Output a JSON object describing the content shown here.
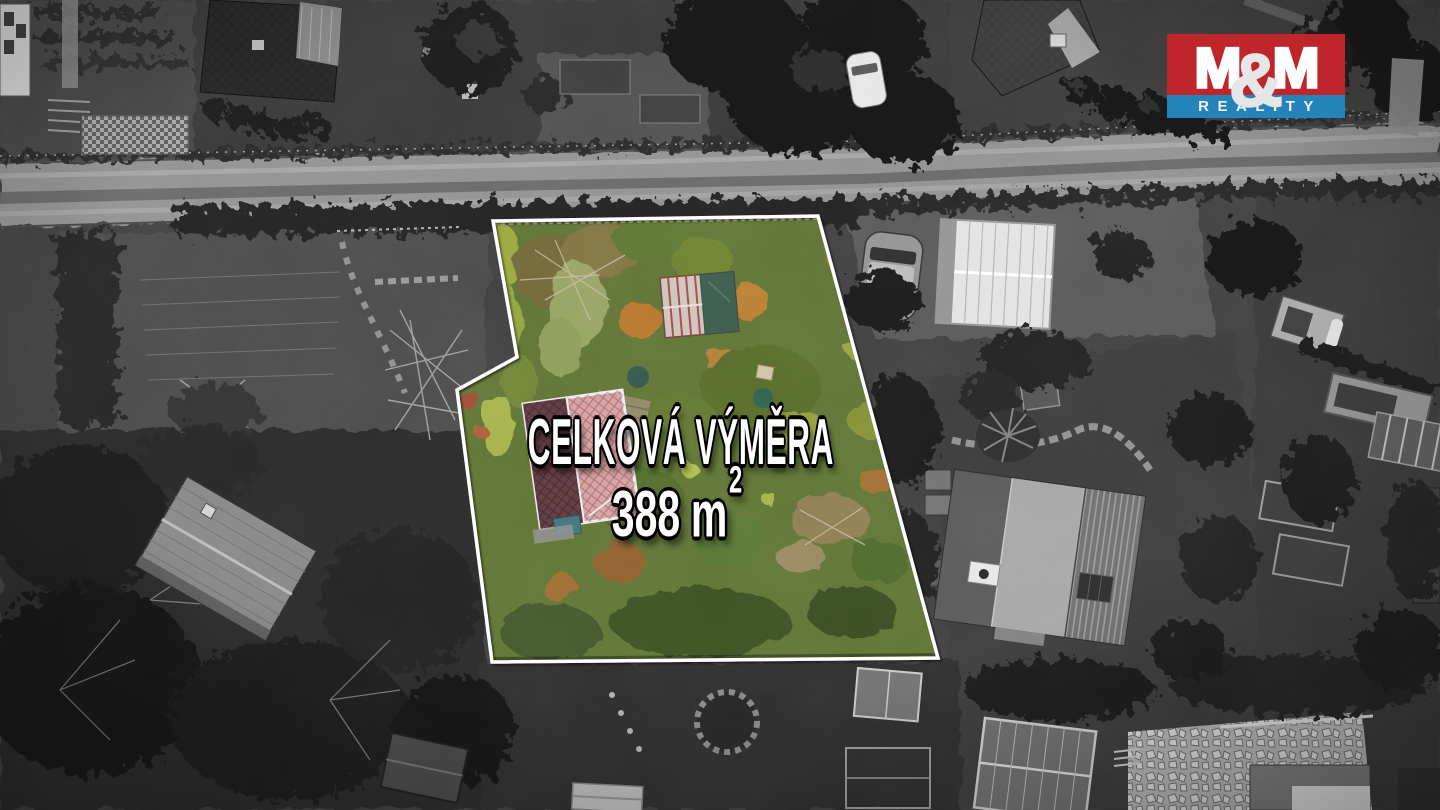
{
  "overlay": {
    "line1": "CELKOVÁ VÝMĚRA",
    "area_value": "388",
    "area_unit": "m",
    "area_exponent": "2",
    "text_color": "#ffffff",
    "outline_color": "#000000"
  },
  "logo": {
    "word_mark_left": "M",
    "word_mark_amp": "&",
    "word_mark_right": "M",
    "subtitle": "REALITY",
    "red": "#bf262c",
    "blue": "#2583bb",
    "text_color": "#ffffff"
  },
  "parcel": {
    "border_color": "#ffffff"
  }
}
